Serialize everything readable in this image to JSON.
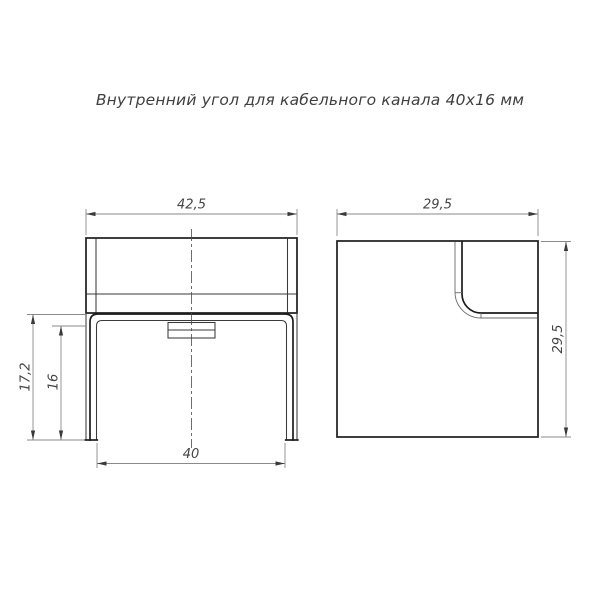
{
  "title": "Внутренний угол для кабельного канала 40х16 мм",
  "views": {
    "front": {
      "dim_width_top": "42,5",
      "dim_height_outer": "17,2",
      "dim_height_inner": "16",
      "dim_width_bottom": "40"
    },
    "side": {
      "dim_width_top": "29,5",
      "dim_height_right": "29,5"
    }
  },
  "colors": {
    "outline": "#1c1c1c",
    "secondary_line": "#3a3a3a",
    "dim_line": "#8a8a8a",
    "text": "#454545",
    "background": "#ffffff"
  }
}
